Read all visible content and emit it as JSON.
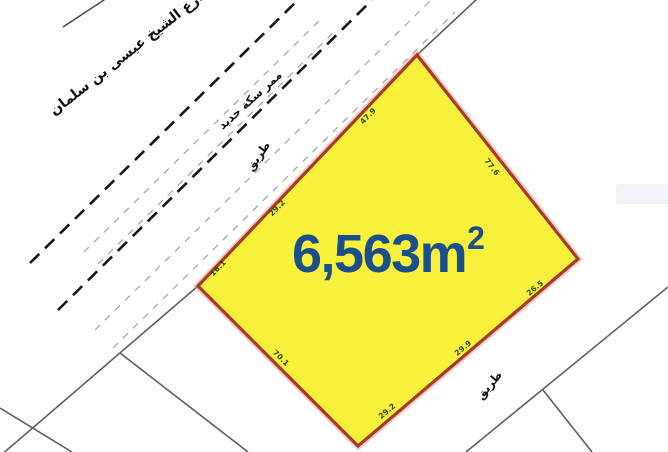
{
  "parcel": {
    "area_value": "6,563m",
    "area_sup": "2",
    "dimensions": [
      {
        "value": "47.9",
        "edge": "northwest"
      },
      {
        "value": "29.2",
        "edge": "northwest"
      },
      {
        "value": "16.1",
        "edge": "northwest"
      },
      {
        "value": "77.6",
        "edge": "northeast"
      },
      {
        "value": "26.5",
        "edge": "southeast"
      },
      {
        "value": "29.9",
        "edge": "southeast"
      },
      {
        "value": "29.2",
        "edge": "southeast"
      },
      {
        "value": "70.1",
        "edge": "southwest"
      }
    ]
  },
  "labels": {
    "street_name": "شارع الشيخ عيسى بن سلمان",
    "railway": "ممر سكة حديد",
    "road_top": "طريق",
    "road_bottom": "طريق"
  },
  "colors": {
    "bg": "#FDFDFB",
    "parcel_fill": "#F8F13B",
    "parcel_stroke": "#A63A2B",
    "parcel_halo": "#E09070",
    "area_text": "#1B4E8C",
    "dim_text": "#2F4A05",
    "line_grey": "#5F5F5F",
    "dash_dark": "#161616",
    "dash_light": "#A3A3A3",
    "text_dark": "#111111",
    "watermark": "#ECF0F4"
  }
}
